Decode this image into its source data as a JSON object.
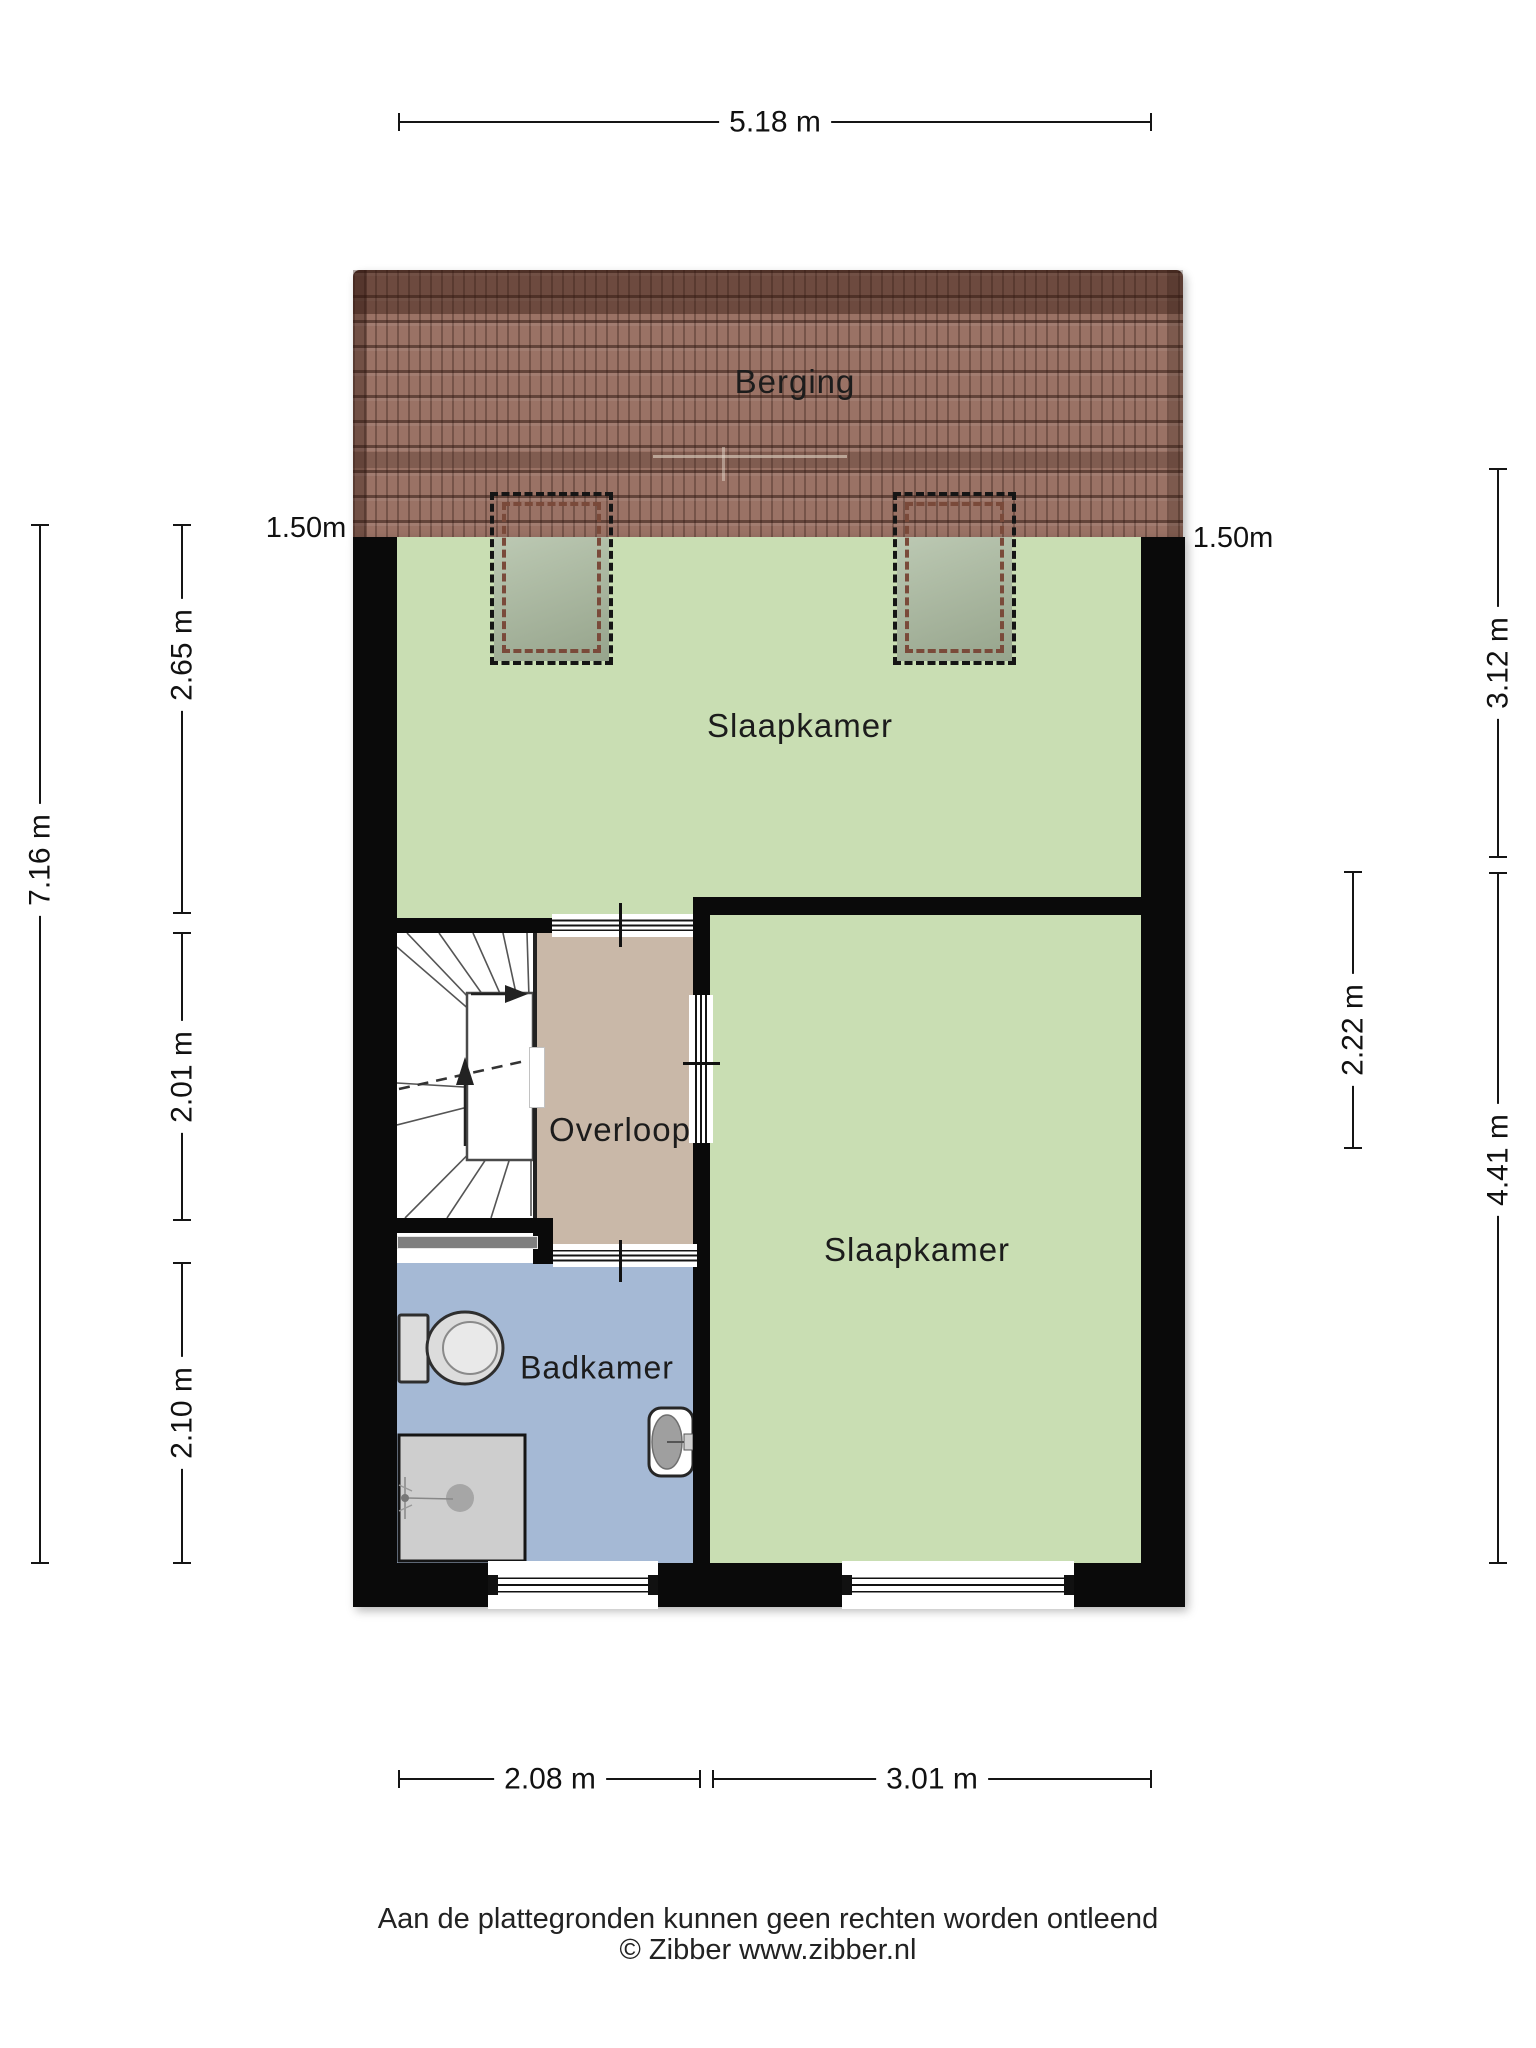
{
  "rooms": {
    "berging": "Berging",
    "slaapkamer_top": "Slaapkamer",
    "overloop": "Overloop",
    "badkamer": "Badkamer",
    "slaapkamer_right": "Slaapkamer"
  },
  "dimensions": {
    "top": "5.18 m",
    "left_outer": "7.16 m",
    "left_inner_1": "2.65 m",
    "left_inner_2": "2.01 m",
    "left_inner_3": "2.10 m",
    "knee_left": "1.50m",
    "knee_right": "1.50m",
    "right_outer_1": "3.12 m",
    "right_outer_2": "4.41 m",
    "right_inner": "2.22 m",
    "bottom_1": "2.08 m",
    "bottom_2": "3.01 m"
  },
  "footer": {
    "disclaimer": "Aan de plattegronden kunnen geen rechten worden ontleend",
    "credit": "© Zibber www.zibber.nl"
  },
  "colors": {
    "room_green": "#c9deb3",
    "hall_tan": "#c9b8a8",
    "bath_blue": "#a5b9d5",
    "roof_base": "#9a7265",
    "wall_black": "#0a0a0a"
  }
}
